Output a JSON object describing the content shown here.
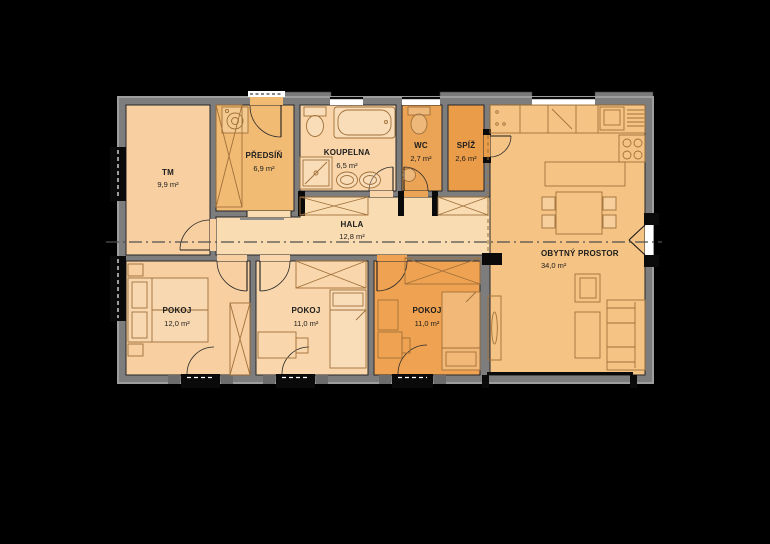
{
  "title": "Floor plan of a family house",
  "colors": {
    "background": "#000000",
    "wall": "#7d7d7d",
    "wall_trim": "#9e9e9e",
    "window_frame": "#0a0a0a",
    "label_text": "#1c1c1c",
    "furniture_line": "#a1713a",
    "section_line": "#4f4f4f"
  },
  "rooms": [
    {
      "id": "tm",
      "name": "TM",
      "area": "9,9 m²",
      "color": "#f7cfa0"
    },
    {
      "id": "predsin",
      "name": "PŘEDSÍŇ",
      "area": "6,9 m²",
      "color": "#f2bb74"
    },
    {
      "id": "koupelna",
      "name": "KOUPELNA",
      "area": "6,5 m²",
      "color": "#f9d5a9"
    },
    {
      "id": "wc",
      "name": "WC",
      "area": "2,7 m²",
      "color": "#eba355"
    },
    {
      "id": "spiz",
      "name": "SPÍŽ",
      "area": "2,6 m²",
      "color": "#ea9c49"
    },
    {
      "id": "hala",
      "name": "HALA",
      "area": "12,8 m²",
      "color": "#fadcb3"
    },
    {
      "id": "obytny-prostor",
      "name": "OBYTNÝ PROSTOR",
      "area": "34,0 m²",
      "color": "#f5c384"
    },
    {
      "id": "pokoj-1",
      "name": "POKOJ",
      "area": "12,0 m²",
      "color": "#f7cfa0"
    },
    {
      "id": "pokoj-2",
      "name": "POKOJ",
      "area": "11,0 m²",
      "color": "#f9d6ab"
    },
    {
      "id": "pokoj-3",
      "name": "POKOJ",
      "area": "11,0 m²",
      "color": "#efa251"
    }
  ]
}
